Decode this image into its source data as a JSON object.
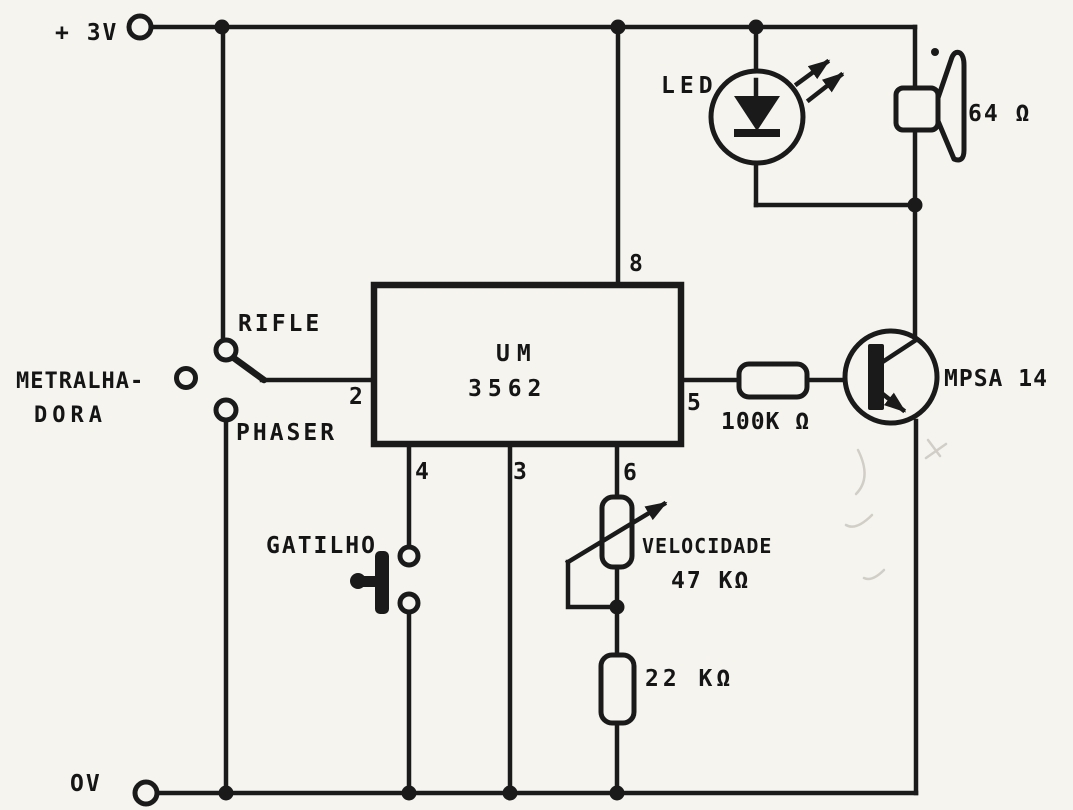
{
  "colors": {
    "ink": "#1a1a1a",
    "paper": "#f5f4ef"
  },
  "rails": {
    "positive": "+ 3V",
    "ground": "OV"
  },
  "ic": {
    "name_line1": "UM",
    "name_line2": "3562",
    "pin_2": "2",
    "pin_3": "3",
    "pin_4": "4",
    "pin_5": "5",
    "pin_6": "6",
    "pin_8": "8"
  },
  "mode_switch": {
    "rifle": "RIFLE",
    "metralhadora_line1": "METRALHA-",
    "metralhadora_line2": "DORA",
    "phaser": "PHASER"
  },
  "trigger_button": {
    "label": "GATILHO"
  },
  "led": {
    "label": "LED"
  },
  "speaker": {
    "impedance": "64 Ω"
  },
  "base_resistor": {
    "value": "100K Ω"
  },
  "speed_pot": {
    "label": "VELOCIDADE",
    "value": "47 KΩ"
  },
  "lower_resistor": {
    "value": "22 KΩ"
  },
  "transistor": {
    "part_number": "MPSA 14"
  }
}
